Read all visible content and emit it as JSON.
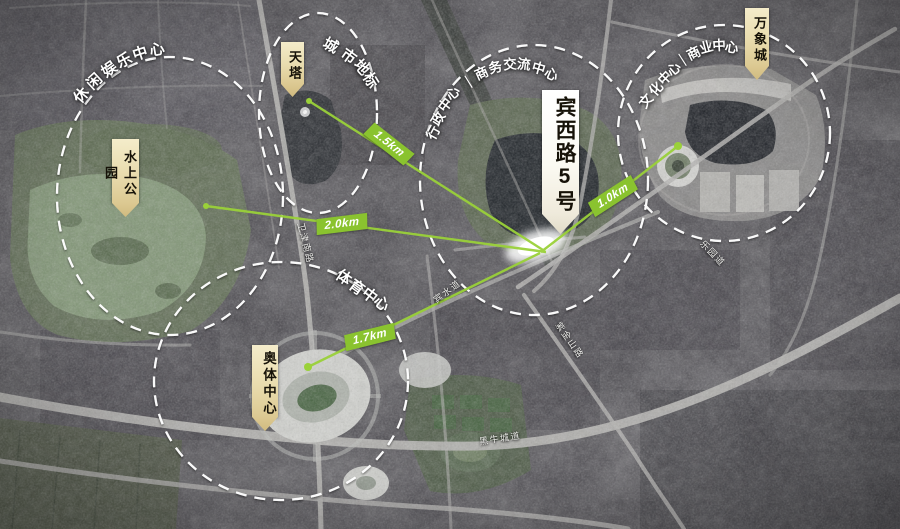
{
  "site": {
    "label": "宾西路5号"
  },
  "landmarks": [
    {
      "label": "水上公园"
    },
    {
      "label": "天塔"
    },
    {
      "label": "万象城"
    },
    {
      "label": "奥体中心"
    }
  ],
  "zones": [
    {
      "label": "休闲娱乐中心"
    },
    {
      "label": "城市地标"
    },
    {
      "label": "行政中心｜商务交流中心"
    },
    {
      "label": "文化中心｜商业中心"
    },
    {
      "label": "体育中心"
    }
  ],
  "distances": [
    {
      "label": "1.5km"
    },
    {
      "label": "2.0km"
    },
    {
      "label": "1.0km"
    },
    {
      "label": "1.7km"
    }
  ],
  "roads": [
    {
      "label": "卫津南路"
    },
    {
      "label": "宾水道"
    },
    {
      "label": "紫金山路"
    },
    {
      "label": "乐园道"
    },
    {
      "label": "黑牛城道"
    }
  ],
  "colors": {
    "accent_green": "#8ac32f",
    "label_tan": "#e9dcae",
    "label_white": "#fdfdf4",
    "dash_white": "#ffffff"
  }
}
